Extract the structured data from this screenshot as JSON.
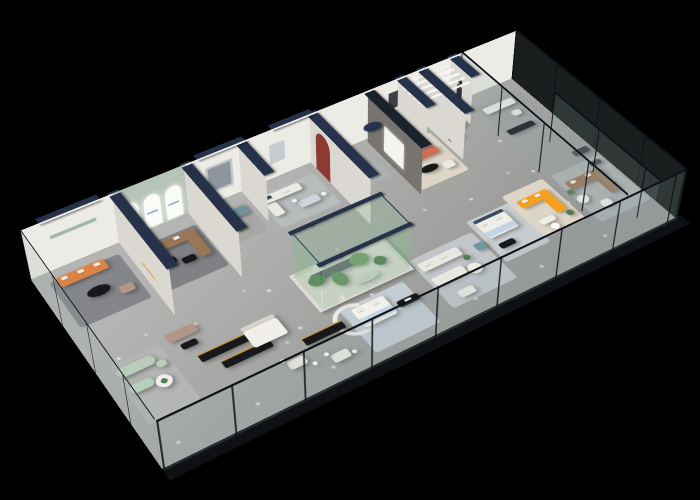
{
  "scene": {
    "title": "3D isometric cutaway floor plan of a furniture showroom on a black background",
    "background": "#000000",
    "areas": [
      {
        "name": "orange-sofa-lounge"
      },
      {
        "name": "arched-display-room"
      },
      {
        "name": "teal-sofa-room"
      },
      {
        "name": "white-sofa-dining-room"
      },
      {
        "name": "feature-wall-coral-lounge"
      },
      {
        "name": "blue-bedroom"
      },
      {
        "name": "yellow-sofa-zone"
      },
      {
        "name": "brown-sofa-glass-room"
      },
      {
        "name": "central-glass-terrarium"
      },
      {
        "name": "sage-green-lounge"
      },
      {
        "name": "black-display-counters"
      },
      {
        "name": "front-dining-area"
      },
      {
        "name": "center-bedroom-vignette"
      },
      {
        "name": "cream-lounge"
      },
      {
        "name": "right-dim-showcase"
      }
    ]
  },
  "palette": {
    "bg": "#000000",
    "wall_light": "#edebe6",
    "wall_shade": "#dbd8d2",
    "wall_cap": "#26324a",
    "glass_frame": "#0c1118",
    "floor_a": "#b4b4b2",
    "floor_b": "#969694",
    "slab_edge": "#0e1013",
    "sage_wall": "#b6c3b8",
    "arch_white": "#fbfbf8",
    "logo_teal": "#2b9fb3",
    "feature_gray": "#767370",
    "niche_red": "#8e3a34",
    "sofa_orange": "#de8442",
    "sofa_coral": "#cf6e52",
    "sofa_yellow": "#f5a01e",
    "sofa_brown": "#9a7658",
    "sofa_taupe": "#b3968a",
    "sofa_teal": "#72919b",
    "sofa_sage": "#b9cdbd",
    "fabric_white": "#ebe9e3",
    "bed_blue": "#c3d4e4",
    "headboard_navy": "#3a4a5e",
    "table_black": "#17181a",
    "counter_gold": "#c69a45",
    "plant_green": "#527c4f",
    "rug_gray": "#c2c6c9",
    "rug_dark": "#84868a",
    "rug_blue": "#c3cdd3",
    "rug_cream": "#ddd6c8"
  }
}
